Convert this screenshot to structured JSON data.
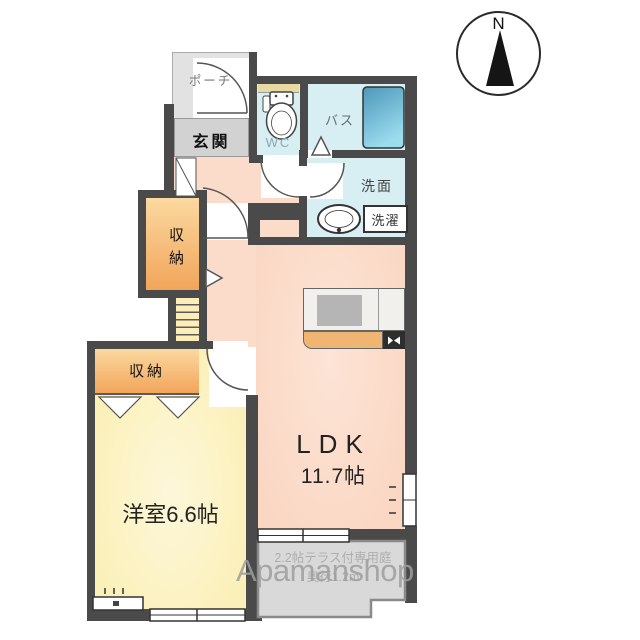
{
  "compass": {
    "north_label": "N"
  },
  "watermark": {
    "text": "Apamanshop"
  },
  "rooms": {
    "porch": {
      "label": "ポーチ"
    },
    "entrance": {
      "label": "玄関"
    },
    "wc": {
      "label": "WC"
    },
    "bath": {
      "label": "バス"
    },
    "washroom": {
      "label": "洗面"
    },
    "laundry": {
      "label": "洗濯"
    },
    "storage_hall": {
      "label": "収納"
    },
    "storage_bedroom": {
      "label": "収納"
    },
    "western_room": {
      "label": "洋室6.6帖"
    },
    "ldk": {
      "name": "LDK",
      "size": "11.7帖"
    },
    "terrace": {
      "note1": "2.2帖テラス付専用庭",
      "note2": "奥行1.2m"
    }
  },
  "colors": {
    "wall": "#4a4a4a",
    "ldk_floor": "#fbdccb",
    "western_floor": "#fbf1bd",
    "wet_area_floor": "#d7eef3",
    "storage_gradient_top": "#fbd9a0",
    "storage_gradient_bottom": "#f2a55a",
    "bathtub_dark": "#4d97ba",
    "bathtub_light": "#9bdcee",
    "counter_front": "#f0b573",
    "terrace_floor": "#d9d9d9",
    "watermark_gray": "#9e9e9e"
  }
}
